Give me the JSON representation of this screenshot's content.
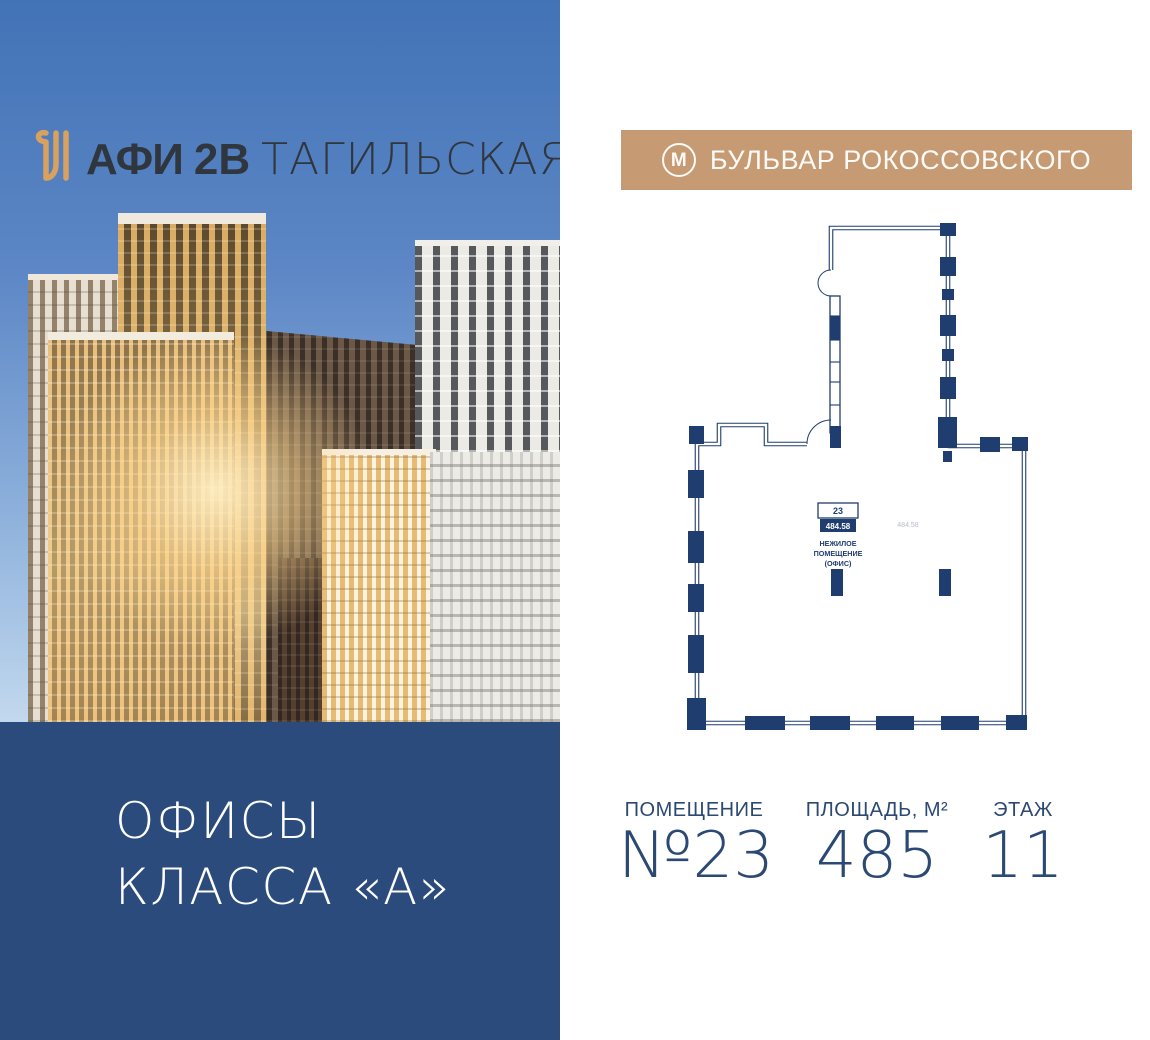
{
  "brand": {
    "logo_mark_icon": "afi-monogram-icon",
    "logo_bold": "АФИ",
    "logo_mid": "2В",
    "logo_light": "ТАГИЛЬСКАЯ",
    "tagline_line1": "ОФИСЫ",
    "tagline_line2": "КЛАССА «А»"
  },
  "metro": {
    "icon_letter": "М",
    "station": "БУЛЬВАР РОКОССОВСКОГО"
  },
  "floorplan": {
    "unit_number": "23",
    "unit_area": "484.58",
    "unit_label_line1": "НЕЖИЛОЕ",
    "unit_label_line2": "ПОМЕЩЕНИЕ",
    "unit_label_line3": "(ОФИС)",
    "area_watermark": "484.58"
  },
  "details": {
    "items": [
      {
        "label": "ПОМЕЩЕНИЕ",
        "value": "№23"
      },
      {
        "label": "ПЛОЩАДЬ, М²",
        "value": "485"
      },
      {
        "label": "ЭТАЖ",
        "value": "11"
      }
    ]
  },
  "colors": {
    "navy_plan": "#1f3d6e",
    "navy_text": "#2b4973",
    "panel_blue": "#2b4b7d",
    "badge_tan": "#c69a73",
    "logo_gold": "#d9a15e",
    "logo_dark": "#30363d",
    "sky_top": "#4273b6",
    "sky_bottom": "#c2d8ee"
  }
}
